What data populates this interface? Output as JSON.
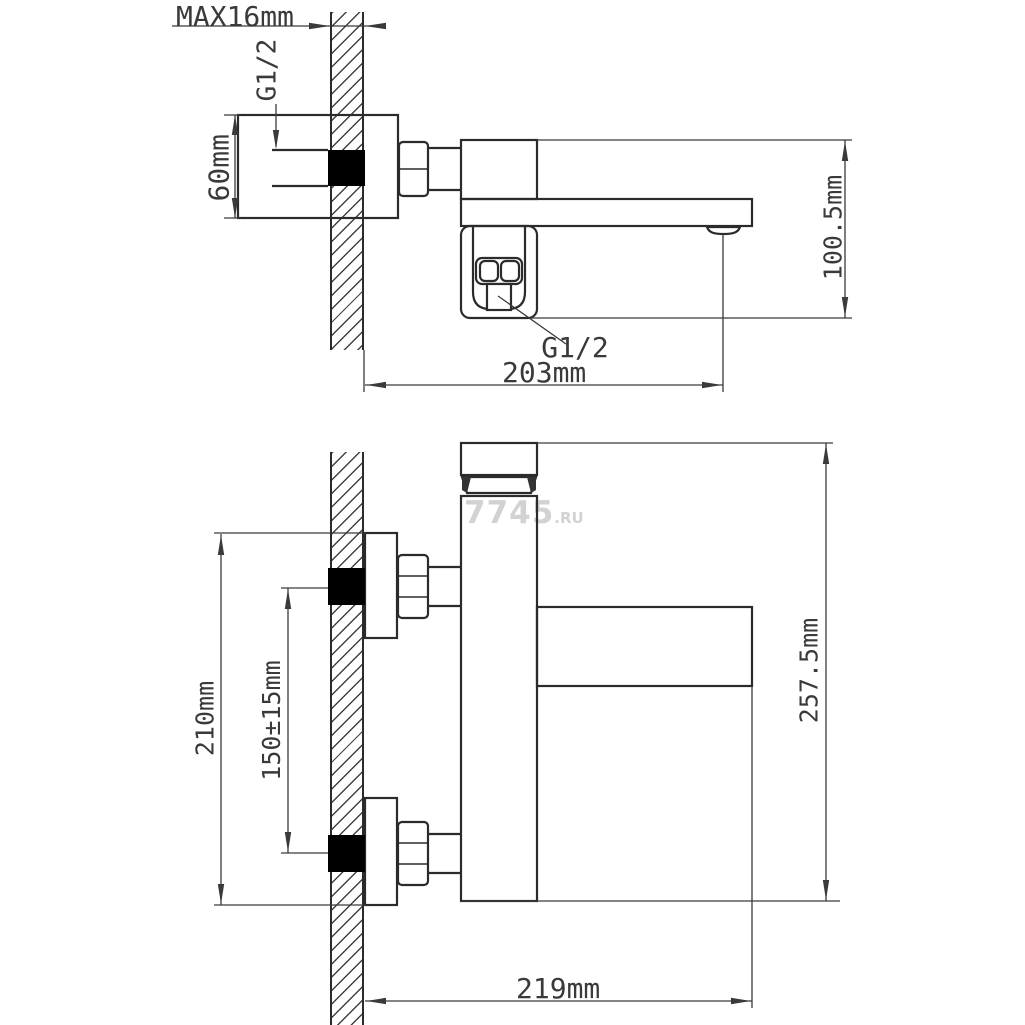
{
  "drawing": {
    "title_hint": "wall-mounted bath mixer installation dimensions, two orthographic views",
    "watermark": {
      "text": "7745",
      "suffix": ".RU"
    },
    "top_view": {
      "wall_thickness_label": "MAX16mm",
      "inlet_thread_label": "G1/2",
      "body_height_label": "60mm",
      "outlet_thread_label": "G1/2",
      "spout_reach_label": "203mm",
      "overall_height_label": "100.5mm"
    },
    "front_view": {
      "plate_height_label": "210mm",
      "hole_spacing_label": "150±15mm",
      "overall_height_label": "257.5mm",
      "spout_reach_label": "219mm"
    },
    "colors": {
      "object_line": "#2b2b2b",
      "dimension_line": "#3a3a3a",
      "hatch": "#2d2d2d",
      "fill_black": "#000000",
      "watermark": "#d2d2d2",
      "background": "#ffffff"
    }
  }
}
